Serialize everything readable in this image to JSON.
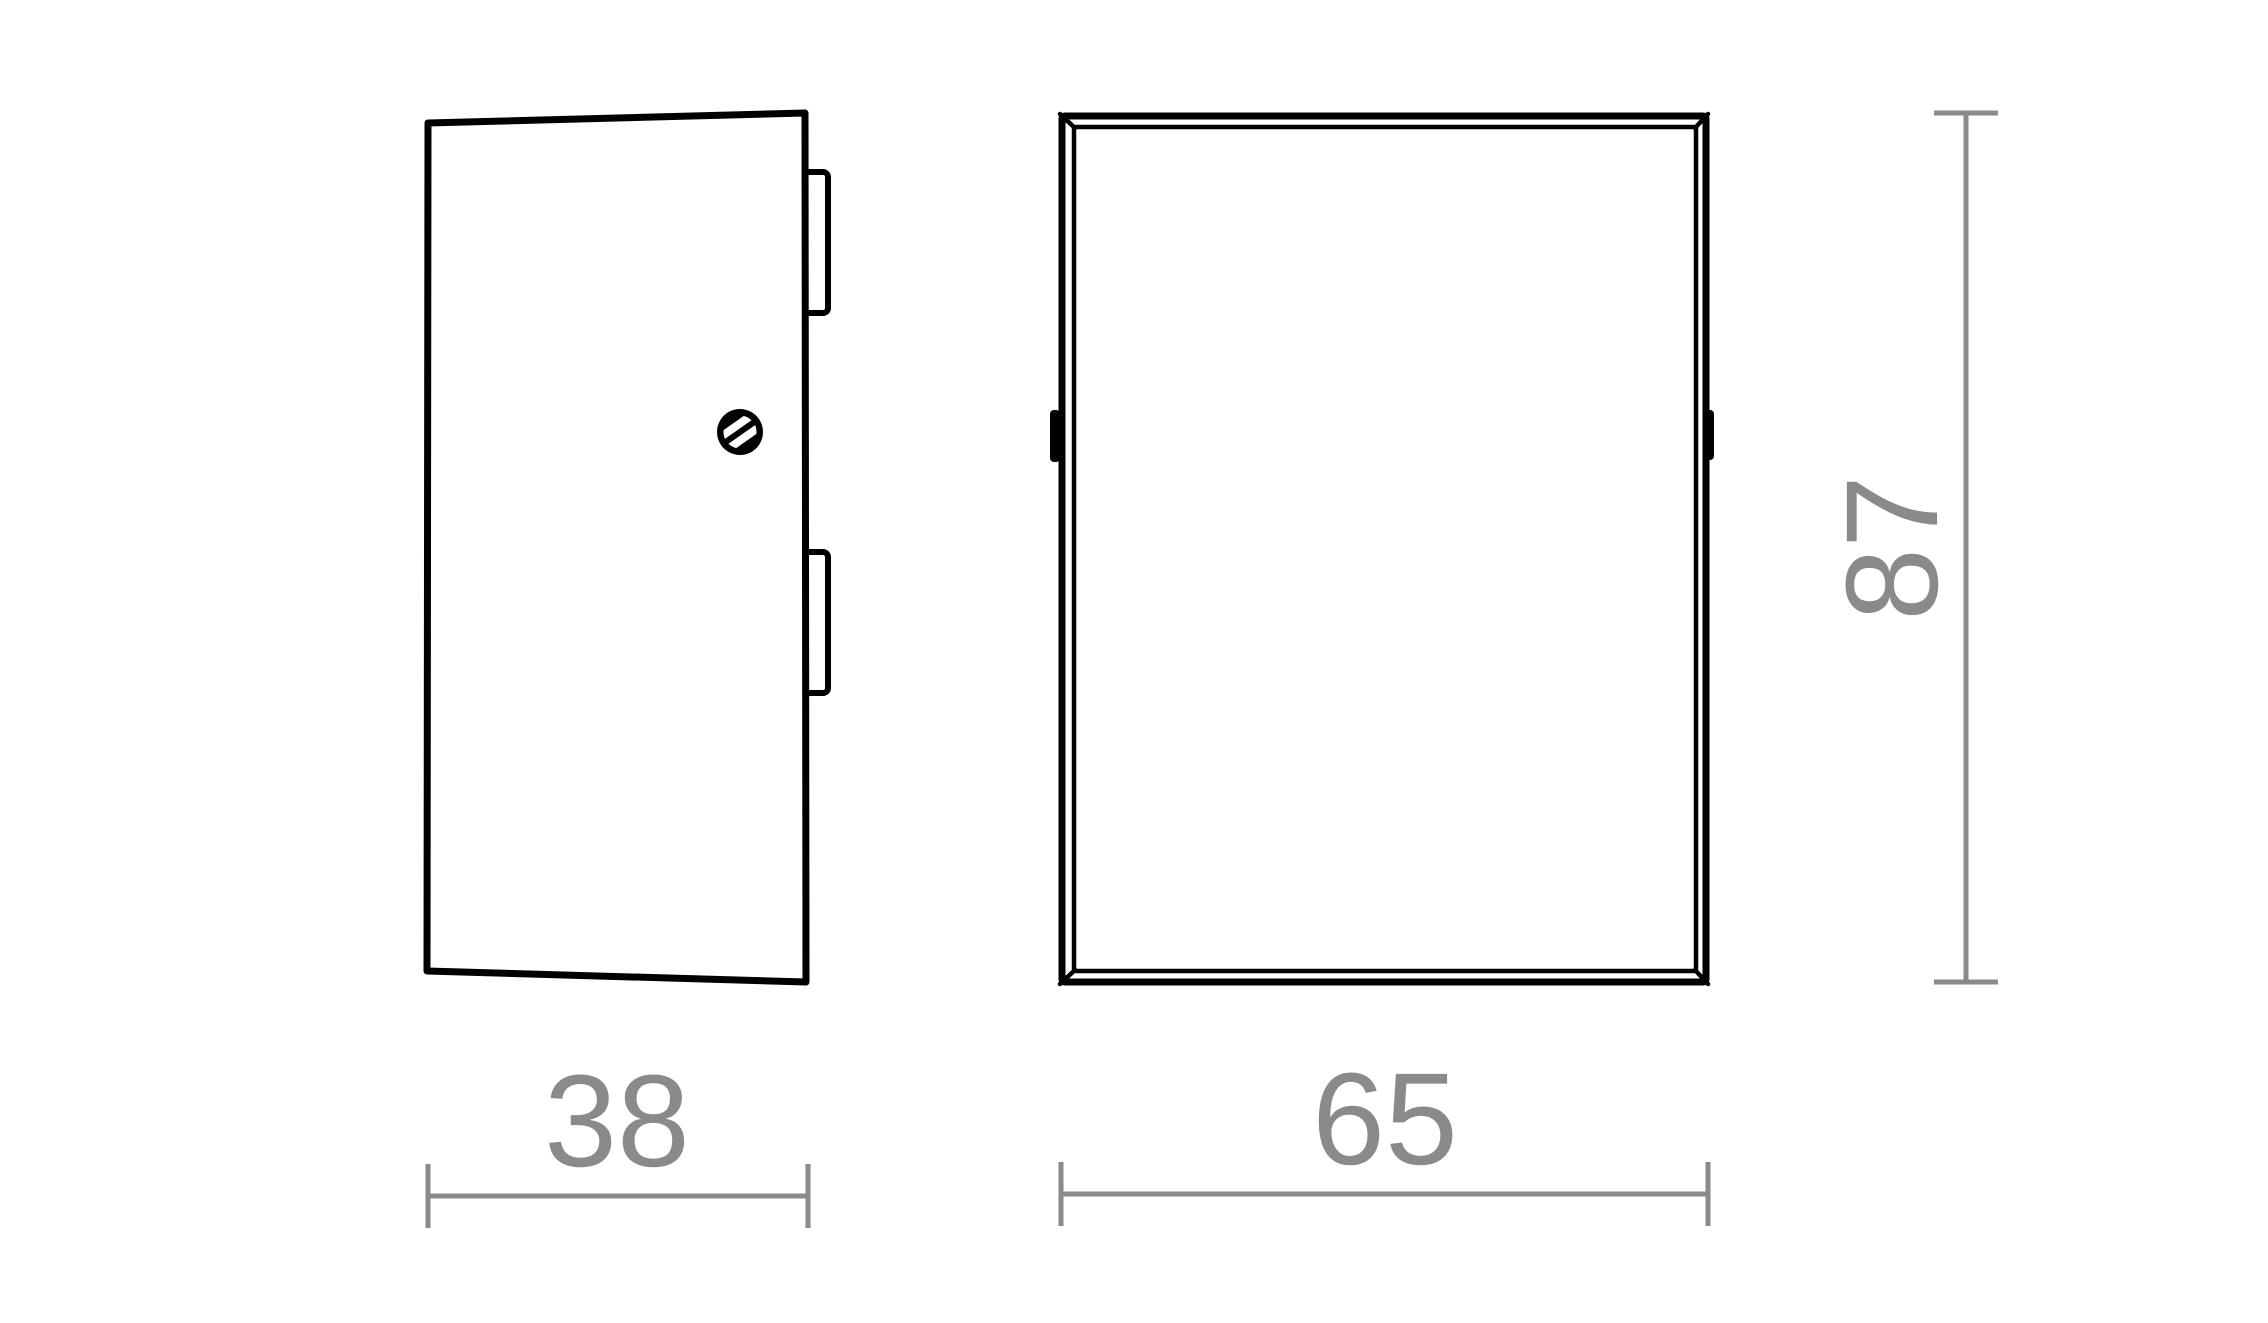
{
  "figure": {
    "views": {
      "side": {
        "width_label": "38"
      },
      "front": {
        "width_label": "65",
        "height_label": "87"
      }
    },
    "icons": {
      "screw": "screw-head-icon",
      "clips": "side-clip"
    },
    "colors": {
      "outline": "#000000",
      "dimension_gray": "#8a8a8a",
      "background": "#ffffff"
    }
  }
}
